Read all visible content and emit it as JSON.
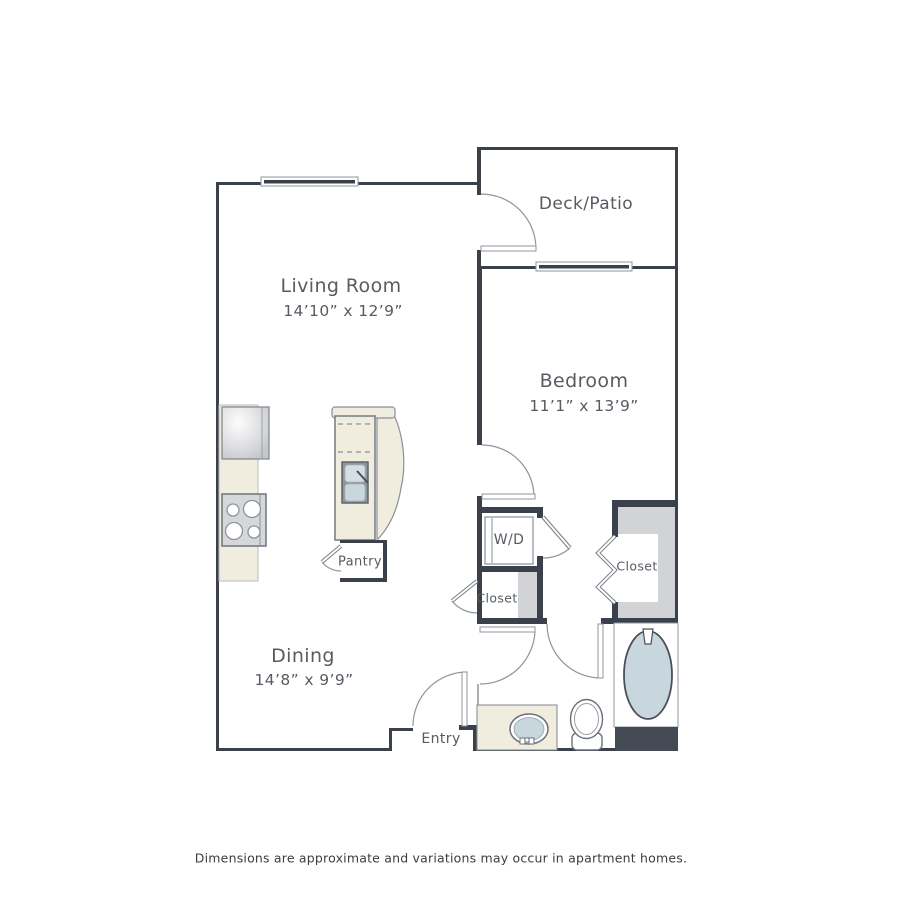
{
  "labels": {
    "deck_patio": "Deck/Patio",
    "living_room": "Living Room",
    "living_dims": "14’10” x 12’9”",
    "bedroom": "Bedroom",
    "bedroom_dims": "11’1” x 13’9”",
    "wd": "W/D",
    "closet_hall": "Closet",
    "closet_bedroom": "Closet",
    "pantry": "Pantry",
    "dining": "Dining",
    "dining_dims": "14’8” x 9’9”",
    "entry": "Entry"
  },
  "footer": {
    "disclaimer": "Dimensions are approximate and variations may occur in apartment homes."
  },
  "colors": {
    "wall": "#3b414b",
    "line": "#8f959c",
    "counter": "#f0edde",
    "fixture_blue": "#c8d7dd",
    "shade": "#d2d3d6",
    "dark_block": "#454b55",
    "label": "#575c63"
  }
}
